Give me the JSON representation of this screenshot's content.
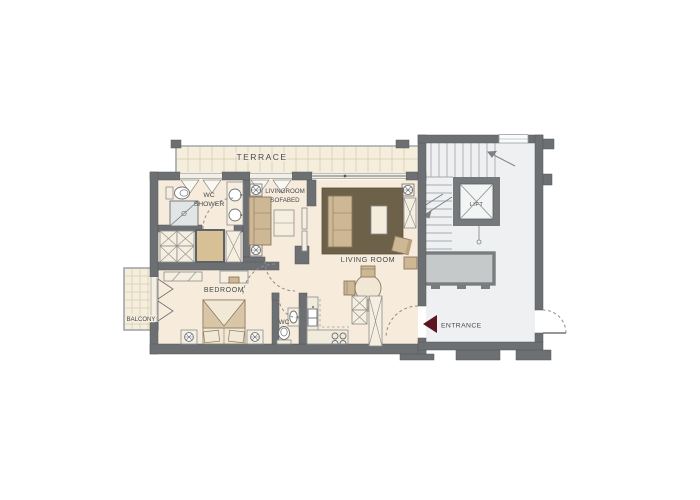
{
  "floorplan": {
    "labels": {
      "terrace": "TERRACE",
      "wc_shower_line1": "WC",
      "wc_shower_line2": "SHOWER",
      "sofabed_line1": "LIVINGROOM",
      "sofabed_line2": "SOFABED",
      "living_room": "LIVING ROOM",
      "bedroom": "BEDROOM",
      "balcony": "BALCONY",
      "wc": "WC",
      "lift": "LIFT",
      "entrance": "ENTRANCE"
    },
    "colors": {
      "wall": "#6d7073",
      "apartment_floor": "#f7ebdb",
      "terrace_floor": "#f5eedd",
      "stairwell_floor": "#eef0f1",
      "rug": "#6e6149",
      "furniture_tan": "#cdb794",
      "furniture_cream": "#f6efdf",
      "shaft": "#d8c096",
      "entrance_arrow": "#5c1623",
      "grid_line": "#d6c9ad",
      "stair_line": "#a7abae",
      "text": "#46494d"
    },
    "symbols": [
      "toilet",
      "shower",
      "double-sink",
      "sofa-bed",
      "wardrobe-x",
      "service-shaft",
      "double-bed",
      "nightstand-lamp",
      "radiator",
      "dining-table",
      "kitchen-counter",
      "kitchen-sink",
      "stove",
      "lift-cross",
      "stairs",
      "door-swing-arc",
      "window-fold-marks",
      "entrance-arrow"
    ]
  }
}
